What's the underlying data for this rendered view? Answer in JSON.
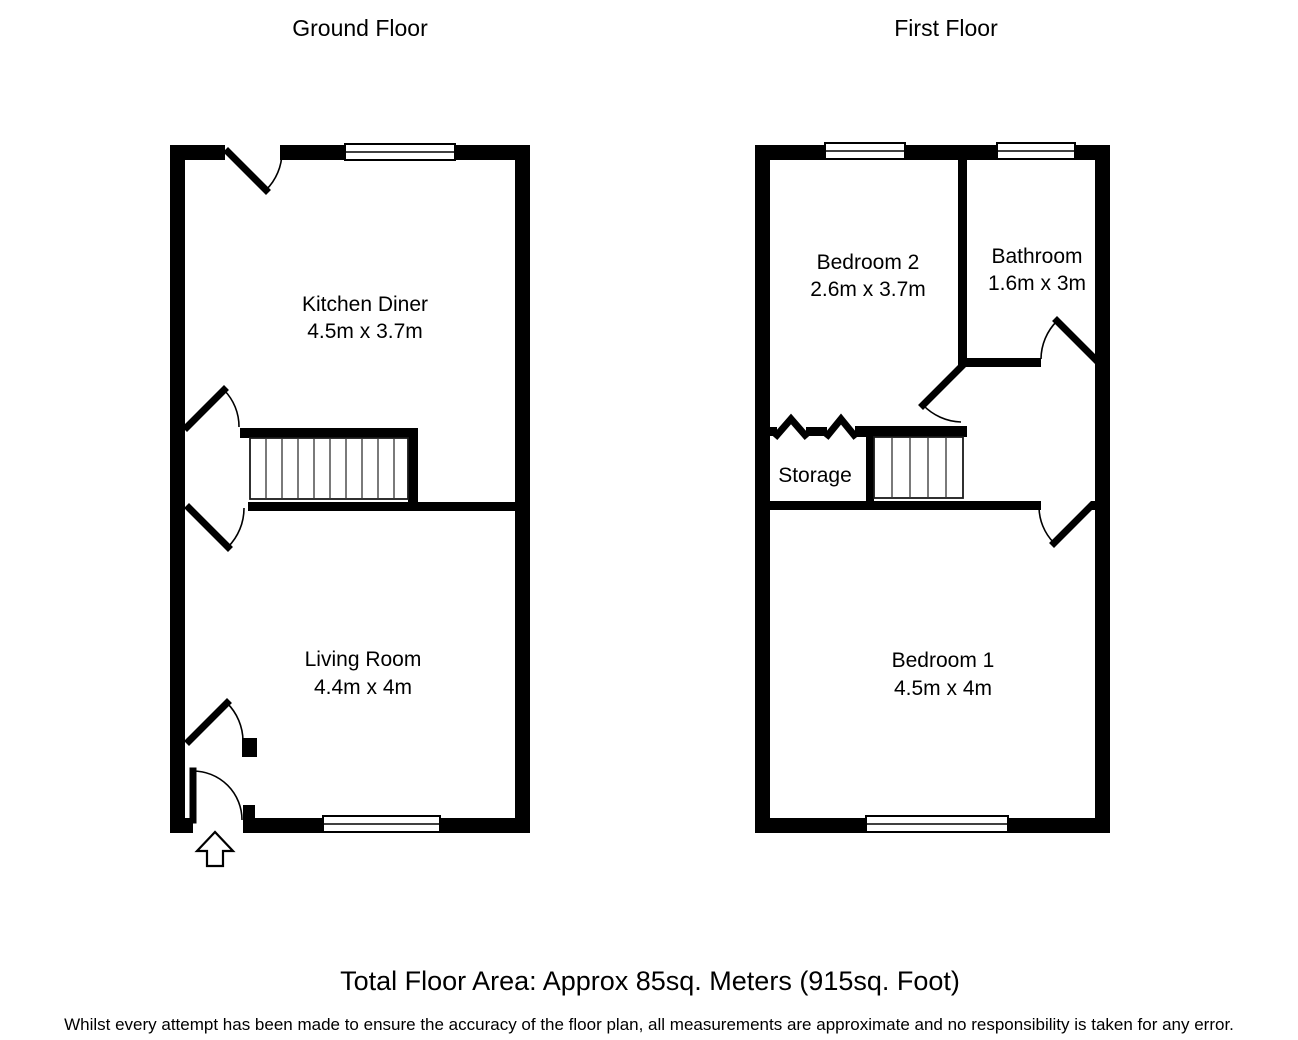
{
  "colors": {
    "wall": "#000000",
    "background": "#ffffff",
    "text": "#000000"
  },
  "ground": {
    "title": "Ground Floor",
    "kitchen": {
      "name": "Kitchen Diner",
      "dims": "4.5m x 3.7m"
    },
    "living": {
      "name": "Living Room",
      "dims": "4.4m x 4m"
    }
  },
  "first": {
    "title": "First Floor",
    "bedroom2": {
      "name": "Bedroom 2",
      "dims": "2.6m x 3.7m"
    },
    "bathroom": {
      "name": "Bathroom",
      "dims": "1.6m x 3m"
    },
    "storage": {
      "name": "Storage"
    },
    "bedroom1": {
      "name": "Bedroom 1",
      "dims": "4.5m x 4m"
    }
  },
  "footer": {
    "total_area": "Total Floor Area: Approx 85sq. Meters (915sq. Foot)",
    "disclaimer": "Whilst every attempt has been made to ensure the accuracy of the floor plan, all measurements are approximate and no responsibility is taken for any error."
  }
}
